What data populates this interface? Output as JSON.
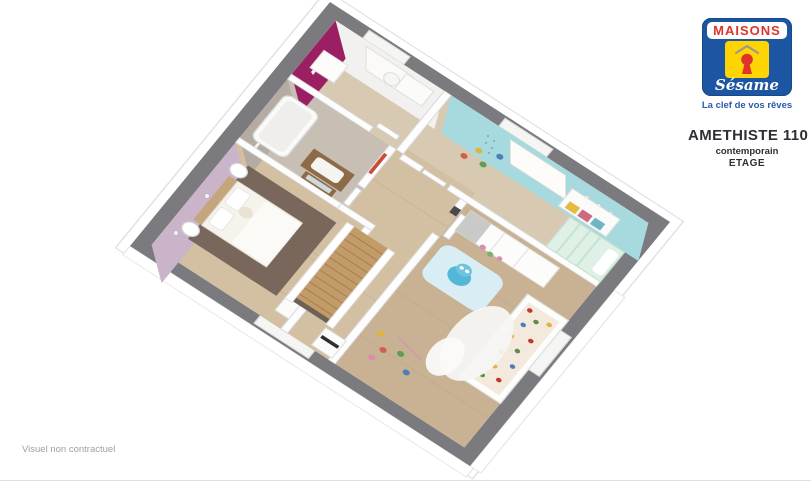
{
  "branding": {
    "name_top": "MAISONS",
    "name_script": "Sésame",
    "tagline": "La clef de vos rêves"
  },
  "model": {
    "name": "AMETHISTE 110",
    "style": "contemporain",
    "level": "ETAGE"
  },
  "footer": {
    "disclaimer": "Visuel non contractuel"
  },
  "icons": {
    "logo_keyhole": "keyhole-in-house-icon"
  },
  "colors": {
    "logo_blue": "#1c55a2",
    "logo_red": "#e0332a",
    "logo_yellow": "#ffd403",
    "tagline_blue": "#2b5ba8",
    "title_dark": "#2e2e35",
    "footer_gray": "#a0a0a0",
    "wall_top_gray": "#7b7a7e",
    "accent_magenta": "#9b1f63",
    "accent_cyan": "#a7dade",
    "accent_lilac": "#c9b4ca",
    "accent_taupe": "#b4aba3",
    "floor_wood_hall": "#d3bfa2",
    "floor_wood_play": "#c9b294",
    "floor_wood_pale": "#d8cab2",
    "floor_bath": "#c7bfb4",
    "stair_wood": "#c29b68",
    "rug_master_brown": "#6e5d52",
    "rug_play_blue": "#d9edf4",
    "bed_mint": "#dff0e6",
    "vanity_wood": "#8d6b46",
    "toy_blue": "#53b7d8"
  }
}
